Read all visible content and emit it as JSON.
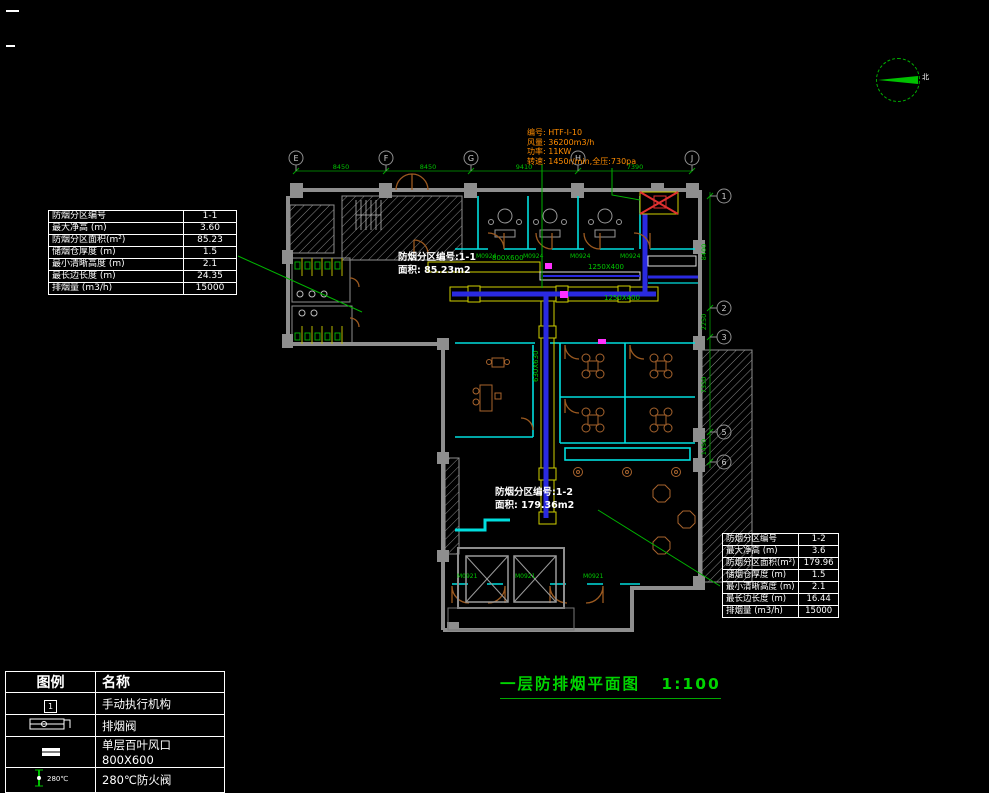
{
  "meta": {
    "title": "一层防排烟平面图",
    "scale": "1:100"
  },
  "compass": {
    "label": "北"
  },
  "fan_note": {
    "lines": [
      "编号: HTF-I-10",
      "风量: 36200m3/h",
      "功率: 11KW",
      "转速: 1450r/min,全压:730pa"
    ]
  },
  "zone1_note": {
    "line1": "防烟分区编号:1-1",
    "line2": "面积: 85.23m2"
  },
  "zone2_note": {
    "line1": "防烟分区编号:1-2",
    "line2": "面积: 179.36m2"
  },
  "zone1_table": {
    "rows": [
      [
        "防烟分区编号",
        "1-1"
      ],
      [
        "最大净高 (m)",
        "3.60"
      ],
      [
        "防烟分区面积(m²)",
        "85.23"
      ],
      [
        "储烟仓厚度 (m)",
        "1.5"
      ],
      [
        "最小清晰高度 (m)",
        "2.1"
      ],
      [
        "最长边长度 (m)",
        "24.35"
      ],
      [
        "排烟量 (m3/h)",
        "15000"
      ]
    ]
  },
  "zone2_table": {
    "rows": [
      [
        "防烟分区编号",
        "1-2"
      ],
      [
        "最大净高 (m)",
        "3.6"
      ],
      [
        "防烟分区面积(m²)",
        "179.96"
      ],
      [
        "储烟仓厚度 (m)",
        "1.5"
      ],
      [
        "最小清晰高度 (m)",
        "2.1"
      ],
      [
        "最长边长度 (m)",
        "16.44"
      ],
      [
        "排烟量 (m3/h)",
        "15000"
      ]
    ]
  },
  "legend": {
    "headers": [
      "图例",
      "名称"
    ],
    "rows": [
      {
        "name": "手动执行机构"
      },
      {
        "name": "排烟阀"
      },
      {
        "name": "单层百叶风口800X600"
      },
      {
        "name": "280℃防火阀"
      }
    ],
    "actuator_num": "1",
    "damper_temp": "280℃"
  },
  "grid": {
    "top_bubbles": [
      "E",
      "F",
      "G",
      "H",
      "J"
    ],
    "top_dims": [
      "8450",
      "8450",
      "9410",
      "7390"
    ],
    "right_bubbles": [
      "1",
      "2",
      "3",
      "5",
      "6"
    ],
    "right_dims": [
      "8400",
      "2250",
      "7350",
      "1450"
    ]
  },
  "plan": {
    "size_labels": [
      "800X600",
      "1250X400",
      "1250X400",
      "630X630"
    ],
    "door_tags_top": [
      "M0924",
      "M0924",
      "M0924",
      "M0924"
    ],
    "door_tags_bottom": [
      "M0921",
      "M0921",
      "M0921"
    ]
  },
  "colors": {
    "background": "#000000",
    "line_white": "#ffffff",
    "wall_gray": "#8e8e8e",
    "partition_cyan": "#00dede",
    "duct_blue": "#2a2ae0",
    "duct_yellow": "#cfcf00",
    "dim_green": "#00b400",
    "annotation_orange": "#ff8c00",
    "door_brown": "#9c5a20",
    "damper_magenta": "#ff30ff",
    "fan_red": "#e03030"
  }
}
